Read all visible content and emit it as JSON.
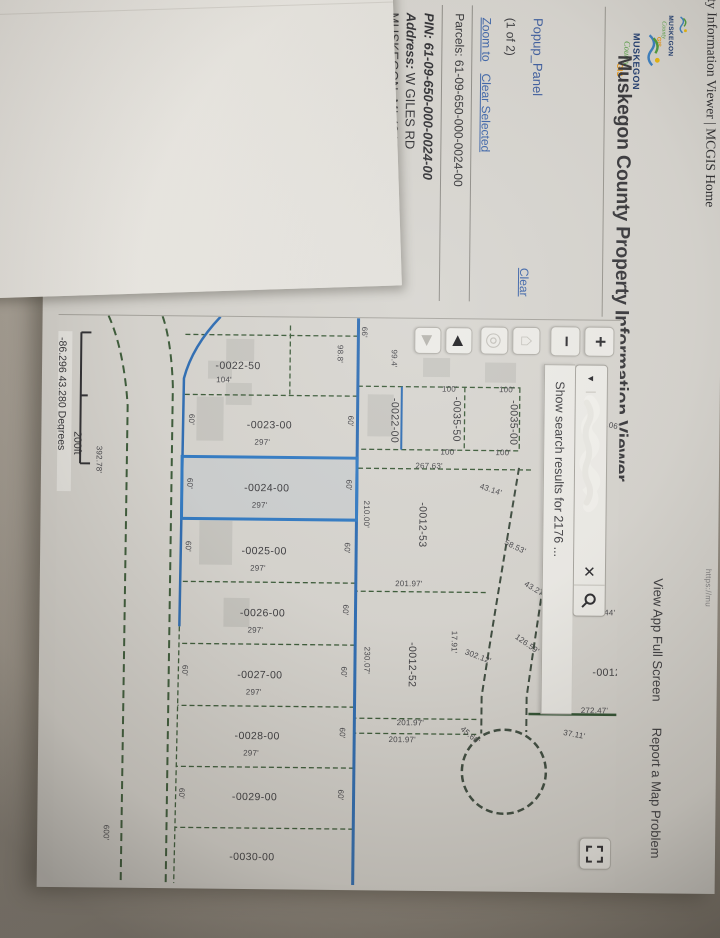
{
  "print_header": {
    "left": "erty Information Viewer | MCGIS Home",
    "url_partial": "https://mu"
  },
  "app": {
    "title": "Muskegon County Property Information Viewer",
    "logo": {
      "name": "MUSKEGON",
      "county": "County",
      "gis": "GIS"
    },
    "links": {
      "fullscreen": "View App Full Screen",
      "report": "Report a Map Problem"
    }
  },
  "popup_panel": {
    "title": "Popup_Panel",
    "clear": "Clear",
    "pager": "(1 of 2)",
    "zoom_to": "Zoom to",
    "clear_selected": "Clear Selected",
    "parcels": "Parcels: 61-09-650-000-0024-00",
    "pin": "PIN: 61-09-650-000-0024-00",
    "address_label": "Address:",
    "address_value": " W GILES RD",
    "city": "MUSKEGON, MI  49445"
  },
  "map": {
    "controls": {
      "zoom_in": "+",
      "zoom_out": "−",
      "prev_extent": "◀",
      "next_extent": "▶",
      "search_dropdown": "▼",
      "search_clear": "✕"
    },
    "search_suggestion": "Show search results for 2176 ...",
    "scale_label": "200ft",
    "coordinates": "-86.296 43.280 Degrees",
    "attribution": "All rights reserved",
    "parcel_labels": [
      {
        "t": "-0022-50",
        "x": 49,
        "y": 382,
        "r": -90
      },
      {
        "t": "-0023-00",
        "x": 108,
        "y": 350,
        "r": -90
      },
      {
        "t": "-0024-00",
        "x": 171,
        "y": 352,
        "r": -90
      },
      {
        "t": "-0025-00",
        "x": 234,
        "y": 354,
        "r": -90
      },
      {
        "t": "-0026-00",
        "x": 296,
        "y": 355,
        "r": -90
      },
      {
        "t": "-0027-00",
        "x": 358,
        "y": 357,
        "r": -90
      },
      {
        "t": "-0028-00",
        "x": 419,
        "y": 359,
        "r": -90
      },
      {
        "t": "-0029-00",
        "x": 480,
        "y": 361,
        "r": -90
      },
      {
        "t": "-0030-00",
        "x": 540,
        "y": 363,
        "r": -90
      },
      {
        "t": "-0035-00",
        "x": 103,
        "y": 106,
        "r": 0
      },
      {
        "t": "-0035-50",
        "x": 100,
        "y": 163,
        "r": 0
      },
      {
        "t": "-0022-00",
        "x": 102,
        "y": 225,
        "r": 0
      },
      {
        "t": "-0012-53",
        "x": 206,
        "y": 196,
        "r": 0
      },
      {
        "t": "-0012-52",
        "x": 346,
        "y": 205,
        "r": 0
      },
      {
        "t": "-0012",
        "x": 352,
        "y": 10,
        "r": -90
      }
    ],
    "dimension_labels": [
      {
        "t": "104'",
        "x": 63,
        "y": 396,
        "r": -90
      },
      {
        "t": "297'",
        "x": 125,
        "y": 357,
        "r": -90
      },
      {
        "t": "297'",
        "x": 188,
        "y": 359,
        "r": -90
      },
      {
        "t": "297'",
        "x": 251,
        "y": 360,
        "r": -90
      },
      {
        "t": "297'",
        "x": 313,
        "y": 362,
        "r": -90
      },
      {
        "t": "297'",
        "x": 375,
        "y": 363,
        "r": -90
      },
      {
        "t": "297'",
        "x": 436,
        "y": 365,
        "r": -90
      },
      {
        "t": "60'",
        "x": 103,
        "y": 269,
        "r": 0
      },
      {
        "t": "60'",
        "x": 167,
        "y": 270,
        "r": 0
      },
      {
        "t": "60'",
        "x": 230,
        "y": 271,
        "r": 0
      },
      {
        "t": "60'",
        "x": 292,
        "y": 272,
        "r": 0
      },
      {
        "t": "60'",
        "x": 354,
        "y": 273,
        "r": 0
      },
      {
        "t": "60'",
        "x": 415,
        "y": 274,
        "r": 0
      },
      {
        "t": "60'",
        "x": 477,
        "y": 275,
        "r": 0
      },
      {
        "t": "60'",
        "x": 103,
        "y": 428,
        "r": 0
      },
      {
        "t": "60'",
        "x": 167,
        "y": 429,
        "r": 0
      },
      {
        "t": "60'",
        "x": 230,
        "y": 430,
        "r": 0
      },
      {
        "t": "60'",
        "x": 354,
        "y": 432,
        "r": 0
      },
      {
        "t": "60'",
        "x": 477,
        "y": 434,
        "r": 0
      },
      {
        "t": "66'",
        "x": 14,
        "y": 256,
        "r": 0
      },
      {
        "t": "98.8'",
        "x": 36,
        "y": 280,
        "r": 0
      },
      {
        "t": "99.4'",
        "x": 40,
        "y": 226,
        "r": 0
      },
      {
        "t": "100'",
        "x": 70,
        "y": 113,
        "r": -90
      },
      {
        "t": "100'",
        "x": 70,
        "y": 170,
        "r": -90
      },
      {
        "t": "100'",
        "x": 133,
        "y": 116,
        "r": -90
      },
      {
        "t": "100'",
        "x": 133,
        "y": 171,
        "r": -90
      },
      {
        "t": "27.06'",
        "x": 104,
        "y": 11,
        "r": -80
      },
      {
        "t": "267.63'",
        "x": 147,
        "y": 190,
        "r": -90
      },
      {
        "t": "201.97'",
        "x": 265,
        "y": 209,
        "r": -90
      },
      {
        "t": "201.97'",
        "x": 404,
        "y": 206,
        "r": -90
      },
      {
        "t": "201.97'",
        "x": 421,
        "y": 214,
        "r": -90
      },
      {
        "t": "210.00'",
        "x": 196,
        "y": 252,
        "r": 0
      },
      {
        "t": "230.07'",
        "x": 342,
        "y": 250,
        "r": 0
      },
      {
        "t": "43.14'",
        "x": 170,
        "y": 128,
        "r": -72
      },
      {
        "t": "58.53'",
        "x": 227,
        "y": 103,
        "r": -65
      },
      {
        "t": "126.59'",
        "x": 324,
        "y": 90,
        "r": -55
      },
      {
        "t": "302.12'",
        "x": 337,
        "y": 139,
        "r": -70
      },
      {
        "t": "17.91'",
        "x": 323,
        "y": 163,
        "r": 0
      },
      {
        "t": "45.60'",
        "x": 416,
        "y": 146,
        "r": -50
      },
      {
        "t": "43.27'",
        "x": 269,
        "y": 83,
        "r": -60
      },
      {
        "t": "37.11'",
        "x": 414,
        "y": 42,
        "r": -80
      },
      {
        "t": "272.44'",
        "x": 292,
        "y": 16,
        "r": -90
      },
      {
        "t": "272.47'",
        "x": 390,
        "y": 22,
        "r": -90
      },
      {
        "t": "392.78'",
        "x": 144,
        "y": 520,
        "r": 0
      },
      {
        "t": "600'",
        "x": 517,
        "y": 509,
        "r": 0
      }
    ]
  }
}
